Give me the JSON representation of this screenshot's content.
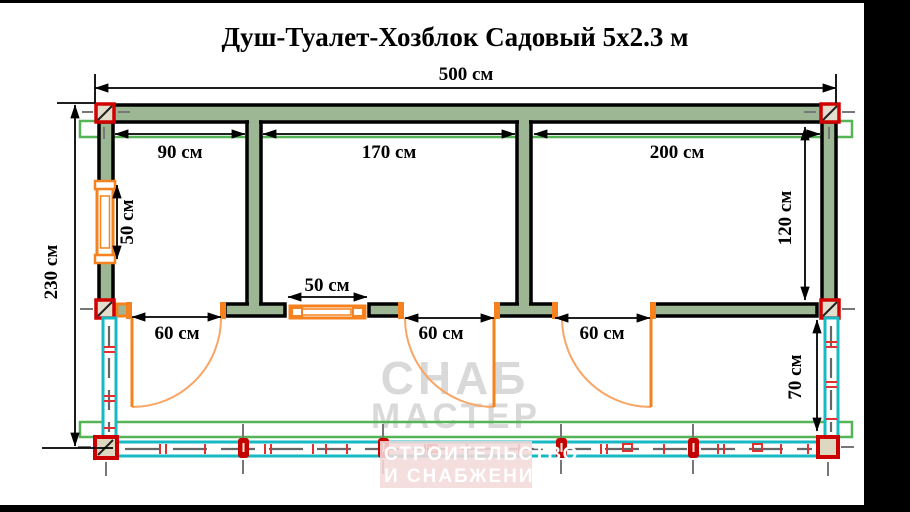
{
  "title": "Душ-Туалет-Хозблок Садовый 5х2.3 м",
  "labels": {
    "total_width": "500 см",
    "total_depth": "230 см",
    "room1_width": "90 см",
    "room2_width": "170 см",
    "room3_width": "200 см",
    "room3_depth": "120 см",
    "side_window_width": "50 см",
    "front_window_width": "50 см",
    "door1_width": "60 см",
    "door2_width": "60 см",
    "door3_width": "60 см",
    "porch_depth": "70 см"
  },
  "watermark": {
    "brand_line1": "СНАБ",
    "brand_line2": "МАСТЕР",
    "tagline_line1": "СТРОИТЕЛЬСТВО",
    "tagline_line2": "И СНАБЖЕНИЕ"
  },
  "colors": {
    "wall_fill": "#9db795",
    "outline_black": "#000000",
    "joinery_orange": "#f5821f",
    "door_arc_orange": "#f9a565",
    "post_red": "#c40000",
    "corner_marker_red": "#d00000",
    "railing_teal": "#16bac5",
    "roof_outline_green": "#55b455",
    "axis_dash_gray": "#777777",
    "watermark_gray": "#d9d9d9",
    "watermark_pink": "#f2dada"
  }
}
